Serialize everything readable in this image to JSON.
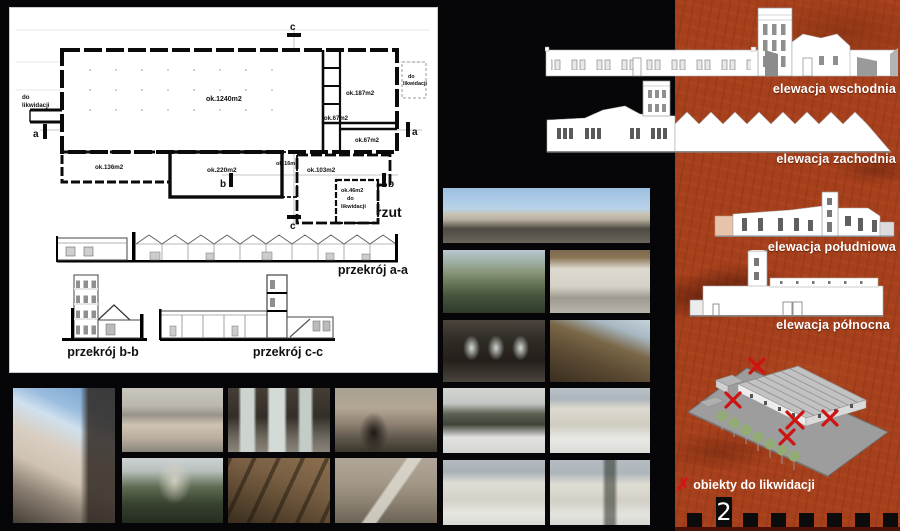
{
  "plan": {
    "title": "rzut",
    "rooms": {
      "main": "ok.1240m2",
      "r187": "ok.187m2",
      "r67a": "ok.67m2",
      "r67b": "ok.67m2",
      "r136": "ok.136m2",
      "r220": "ok.220m2",
      "r16": "ok.16m2",
      "r103": "ok.103m2",
      "r46": "ok.46m2"
    },
    "demolition_left": {
      "line1": "do",
      "line2": "likwidacji"
    },
    "demolition_right": {
      "line1": "do",
      "line2": "likwidacji"
    },
    "demolition_small": {
      "line1": "do",
      "line2": "likwidacji"
    },
    "markers": {
      "a": "a",
      "b": "b",
      "c": "c"
    }
  },
  "sections": {
    "aa": "przekrój a-a",
    "bb": "przekrój b-b",
    "cc": "przekrój c-c"
  },
  "elevations": {
    "east": "elewacja wschodnia",
    "west": "elewacja zachodnia",
    "south": "elewacja południowa",
    "north": "elewacja północna"
  },
  "legend": {
    "mark": "✗",
    "label": "obiekty do likwidacji"
  },
  "footer": {
    "page_number": "2"
  },
  "colors": {
    "panel_orange": "#a63f1b",
    "demolition_red": "#d41515",
    "drawing_ink": "#000000",
    "label_white": "#ffffff"
  },
  "photos": {
    "ph1": "factory complex with tower and street lamps",
    "ph2": "derelict outbuildings among trees",
    "ph3": "warehouse interior with timber roof",
    "ph4": "dark hall interior with bright windows",
    "ph5": "collapsed attic roof with sky showing",
    "ph6": "snowy yard with conifers and low building",
    "ph7": "snow-covered cottage facade",
    "ph8": "single-storey building in snow",
    "ph9": "white outbuildings in snowy yard",
    "ph10": "tower facade seen from below",
    "ph11": "tower top with pyramidal roof",
    "ph12": "hall interior with arched windows",
    "ph13": "weathered facade with dark doorway",
    "ph14": "tower behind trees",
    "ph15": "timber roof trusses in attic",
    "ph16": "courtyard wall with external stair"
  }
}
